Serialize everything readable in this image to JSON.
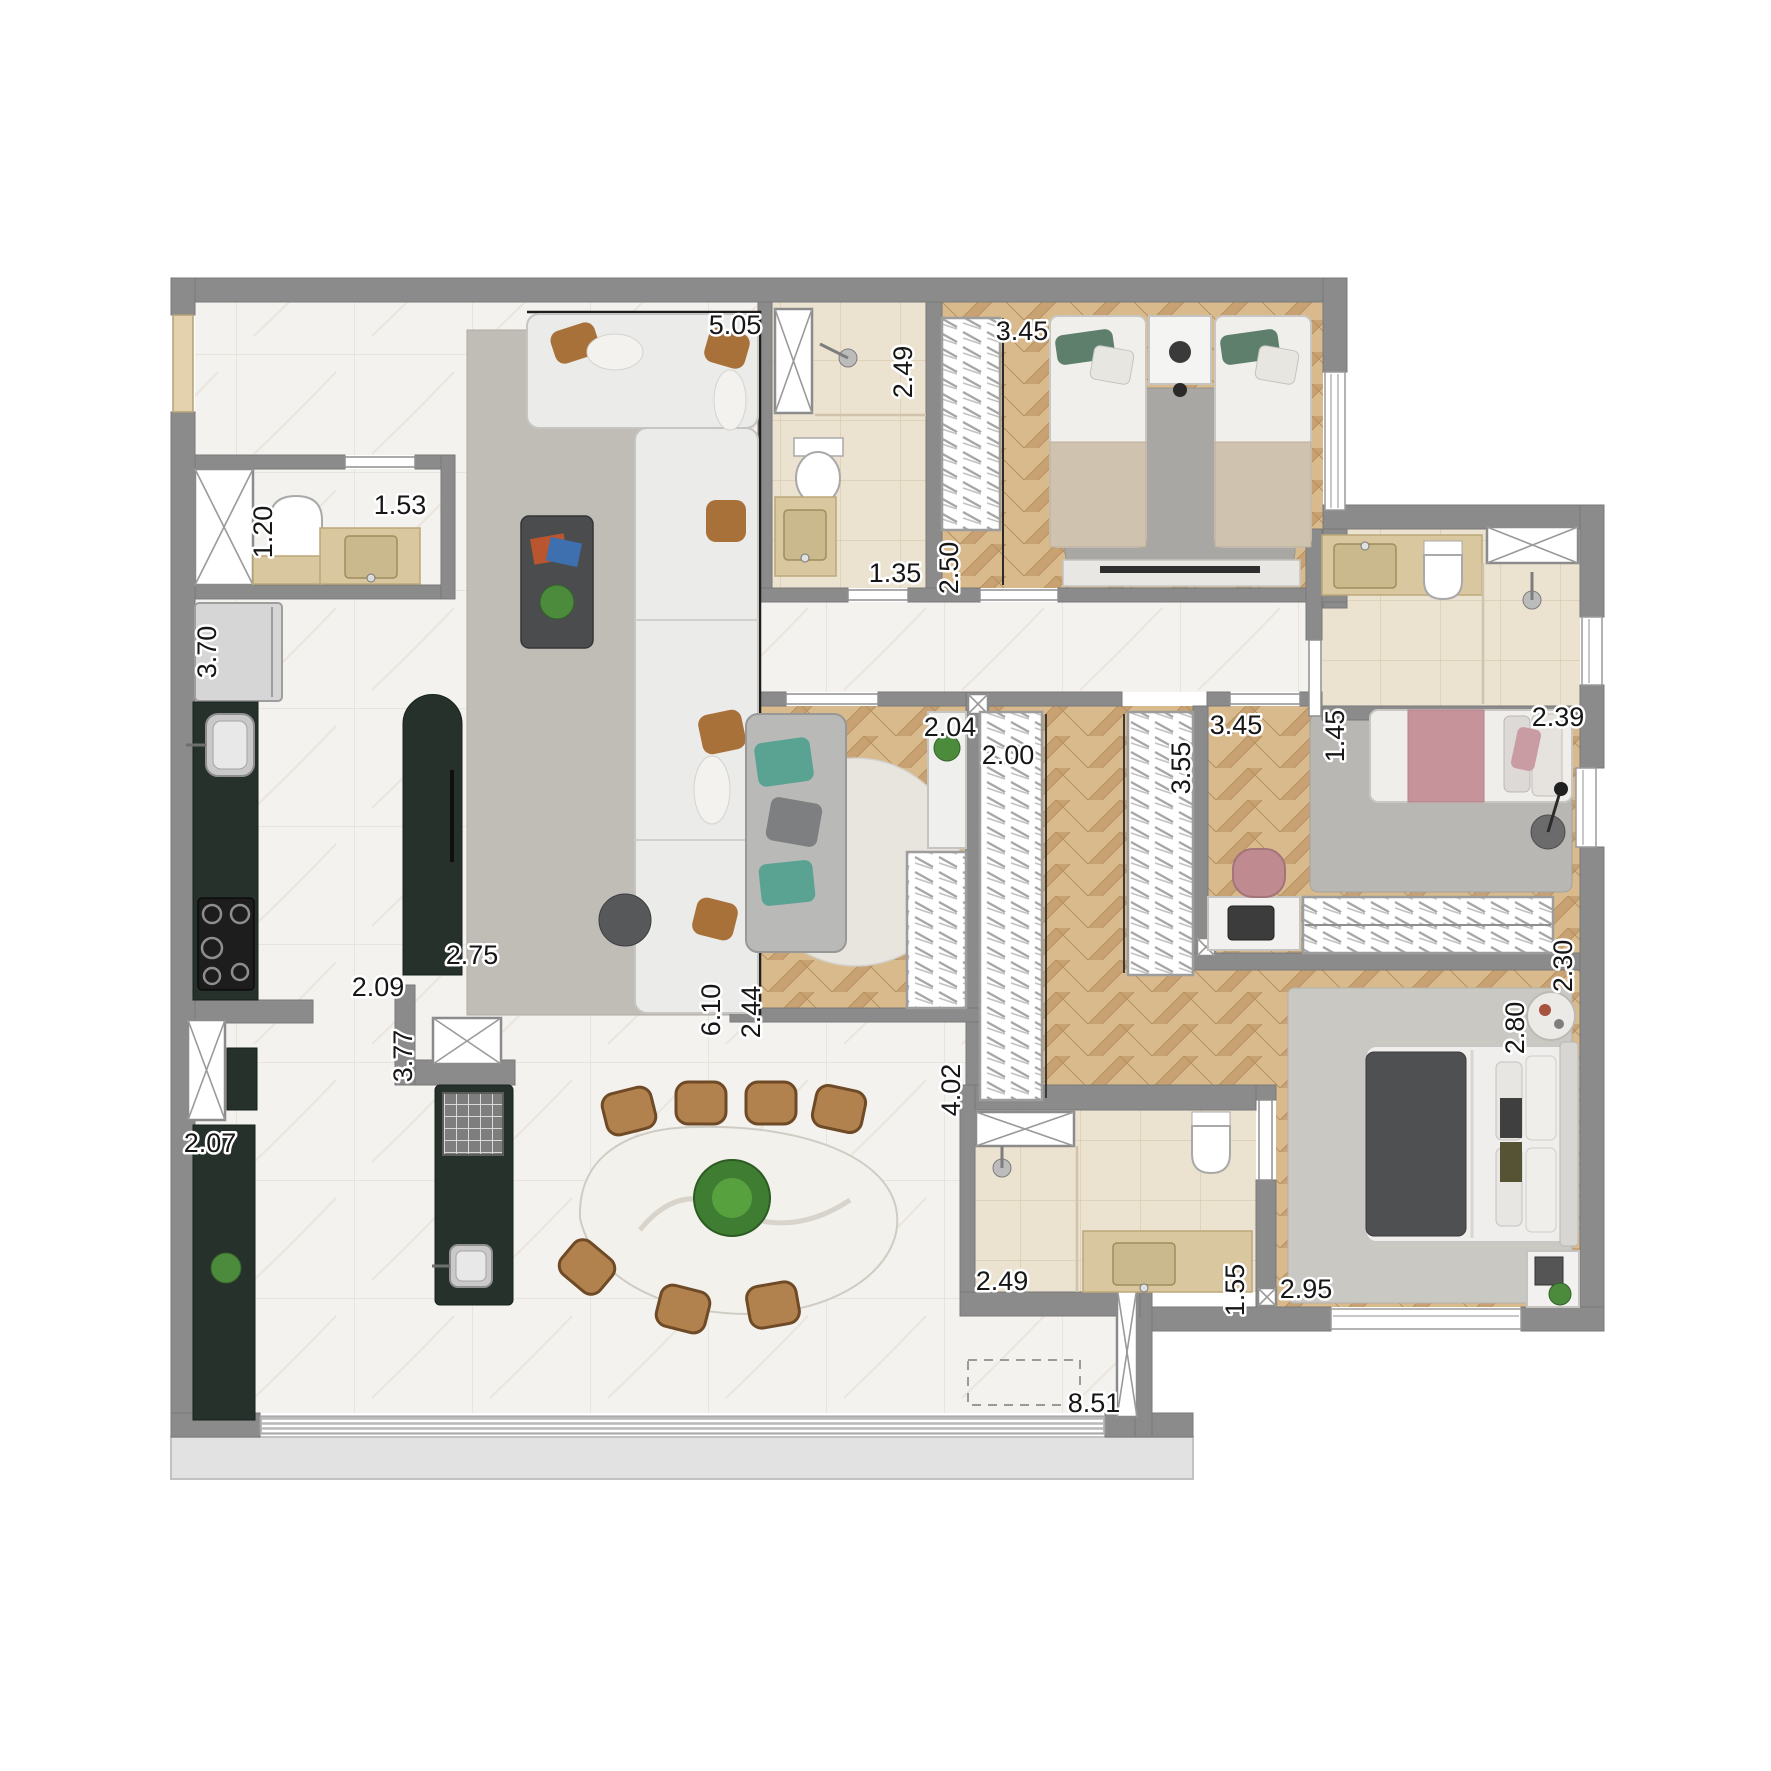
{
  "floor_plan": {
    "type": "apartment-floor-plan",
    "dimension_labels": [
      {
        "area": "living-sofa",
        "value": "5.05"
      },
      {
        "area": "bath-social-width",
        "value": "2.49"
      },
      {
        "area": "twin-bedroom-wardrobe",
        "value": "3.45"
      },
      {
        "area": "lavabo-width",
        "value": "1.20"
      },
      {
        "area": "lavabo-length",
        "value": "1.53"
      },
      {
        "area": "bath-social-length",
        "value": "1.35"
      },
      {
        "area": "twin-bedroom-depth",
        "value": "2.50"
      },
      {
        "area": "kitchen-length",
        "value": "3.70"
      },
      {
        "area": "kitchen-island",
        "value": "2.75"
      },
      {
        "area": "kitchen-width",
        "value": "2.09"
      },
      {
        "area": "kitchen-island-run",
        "value": "3.77"
      },
      {
        "area": "living-length",
        "value": "6.10"
      },
      {
        "area": "tv-room-depth",
        "value": "2.44"
      },
      {
        "area": "tv-room-console",
        "value": "2.04"
      },
      {
        "area": "closet-left-wardrobe",
        "value": "2.00"
      },
      {
        "area": "closet-right-wardrobe",
        "value": "3.55"
      },
      {
        "area": "pink-bedroom-width",
        "value": "3.45"
      },
      {
        "area": "bath-suite2-width",
        "value": "1.45"
      },
      {
        "area": "bath-suite2-length",
        "value": "2.39"
      },
      {
        "area": "pink-bedroom-depth",
        "value": "2.30"
      },
      {
        "area": "closet-length",
        "value": "4.02"
      },
      {
        "area": "master-bedroom-width",
        "value": "2.80"
      },
      {
        "area": "master-bedroom-length",
        "value": "2.95"
      },
      {
        "area": "master-bath-shower",
        "value": "2.49"
      },
      {
        "area": "master-bath-vanity",
        "value": "1.55"
      },
      {
        "area": "gourmet-counter",
        "value": "2.07"
      },
      {
        "area": "balcony-front",
        "value": "8.51"
      }
    ],
    "palette": {
      "wall": "#8b8b8b",
      "marble_floor": "#f4f2ee",
      "bath_tile": "#ebe2d0",
      "wood_floor": "#d9bc92",
      "cabinet_dark": "#26312b",
      "counter_travertine": "#d9c79f",
      "rug_gray": "#bfbcb7",
      "accent_teal": "#5aa392",
      "accent_pink": "#c6969c",
      "chair_brown": "#b2824e",
      "plant_green": "#4c8a3c",
      "balcony_slab": "#e2e2e2"
    }
  }
}
